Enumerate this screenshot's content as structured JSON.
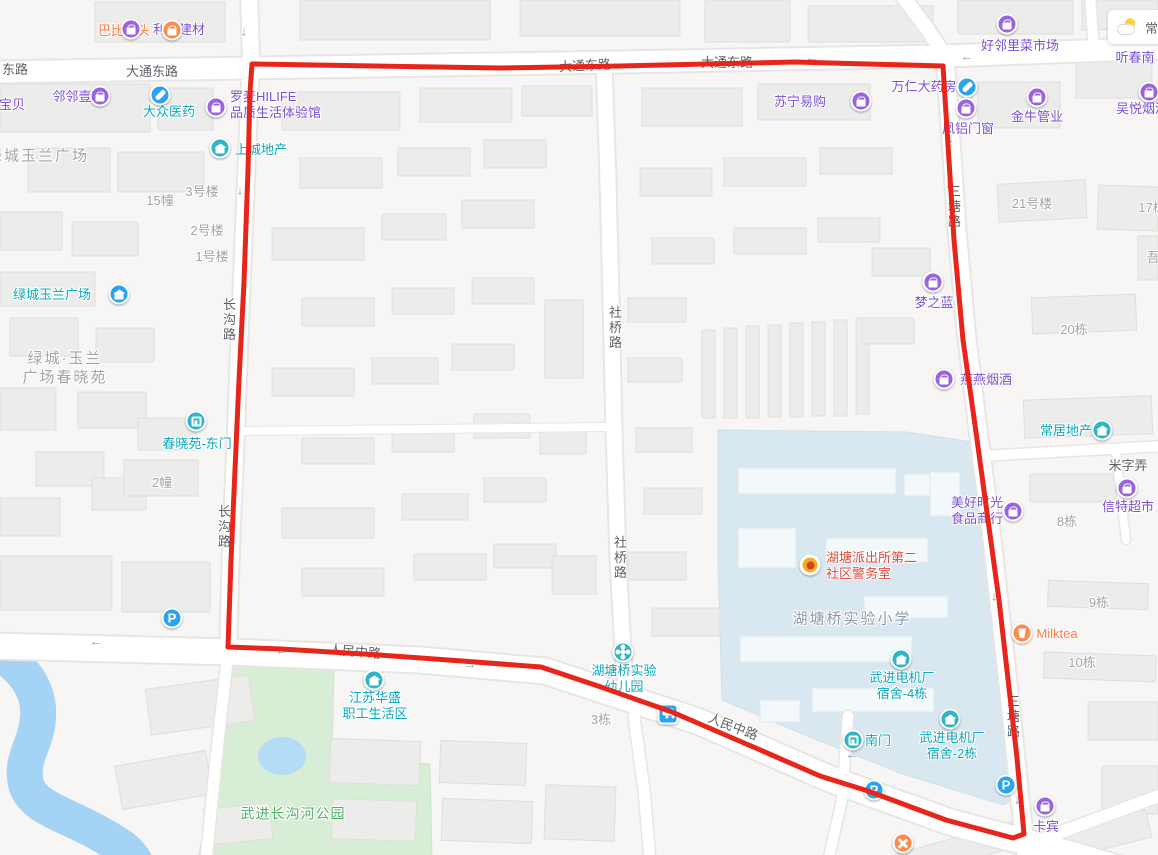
{
  "map": {
    "weather": {
      "city": "常州"
    },
    "colors": {
      "route_red": "#e8251a",
      "poi_purple": "#7b50d2",
      "poi_teal": "#0ba7b8",
      "poi_orange": "#ff7b40",
      "poi_red": "#de4a3c",
      "park_green_text": "#4fae67",
      "gray_label": "#a3a3a3",
      "road_label": "#5d6166",
      "school_text": "#8d99a6",
      "icon_purple": "#9a63df",
      "icon_teal": "#2fb5c5",
      "icon_blue": "#2aa3f3",
      "icon_orange": "#ff8a4e",
      "water": "#a5d3f5",
      "park": "#d8edd6",
      "campus": "#d9e7f0"
    },
    "road_labels": [
      {
        "t": "东路",
        "x": 15,
        "y": 70
      },
      {
        "t": "大通东路",
        "x": 152,
        "y": 72
      },
      {
        "t": "大通东路",
        "x": 585,
        "y": 66,
        "rot": -3
      },
      {
        "t": "大通东路",
        "x": 727,
        "y": 63
      },
      {
        "t": "长沟路",
        "x": 228,
        "y": 320,
        "v": 1
      },
      {
        "t": "长沟路",
        "x": 223,
        "y": 527,
        "v": 1
      },
      {
        "t": "社桥路",
        "x": 614,
        "y": 328,
        "v": 1
      },
      {
        "t": "社桥路",
        "x": 619,
        "y": 558,
        "v": 1
      },
      {
        "t": "三塘路",
        "x": 953,
        "y": 207,
        "v": 1
      },
      {
        "t": "三塘路",
        "x": 1012,
        "y": 717,
        "v": 1
      },
      {
        "t": "人民中路",
        "x": 355,
        "y": 652,
        "rot": 5
      },
      {
        "t": "人民中路",
        "x": 733,
        "y": 727,
        "rot": 21
      },
      {
        "t": "米字弄",
        "x": 1128,
        "y": 466
      }
    ],
    "area_labels": [
      {
        "t": "绿城玉兰广场",
        "x": 38,
        "y": 156
      },
      {
        "t": "绿城·玉兰\n广场春晓苑",
        "x": 65,
        "y": 368
      },
      {
        "t": "湖塘桥实验小学",
        "x": 852,
        "y": 619,
        "c": "grayblue"
      },
      {
        "t": "武进长沟河公园",
        "x": 293,
        "y": 814,
        "c": "green"
      }
    ],
    "building_labels": [
      {
        "t": "3号楼",
        "x": 202,
        "y": 192
      },
      {
        "t": "15幢",
        "x": 160,
        "y": 201
      },
      {
        "t": "2号楼",
        "x": 207,
        "y": 231
      },
      {
        "t": "1号楼",
        "x": 212,
        "y": 257
      },
      {
        "t": "2幢",
        "x": 162,
        "y": 483
      },
      {
        "t": "21号楼",
        "x": 1032,
        "y": 204
      },
      {
        "t": "17栋",
        "x": 1152,
        "y": 208
      },
      {
        "t": "吾",
        "x": 1153,
        "y": 258
      },
      {
        "t": "20栋",
        "x": 1074,
        "y": 330
      },
      {
        "t": "8栋",
        "x": 1067,
        "y": 522
      },
      {
        "t": "9栋",
        "x": 1099,
        "y": 603
      },
      {
        "t": "10栋",
        "x": 1082,
        "y": 663
      },
      {
        "t": "3栋",
        "x": 601,
        "y": 720
      }
    ],
    "pois": [
      {
        "t": "巴比馒头",
        "x": 124,
        "y": 31,
        "c": "orange",
        "icon": "bag",
        "ic": "orange",
        "ix": 172,
        "iy": 30
      },
      {
        "t": "利来建材",
        "x": 179,
        "y": 30,
        "c": "purple",
        "icon": "bag",
        "ic": "purple",
        "ix": 131,
        "iy": 29
      },
      {
        "t": "邻邻壹",
        "x": 72,
        "y": 97,
        "c": "purple",
        "icon": "bag",
        "ic": "purple",
        "ix": 100,
        "iy": 96
      },
      {
        "t": "宝贝",
        "x": 12,
        "y": 105,
        "c": "purple"
      },
      {
        "t": "大众医药",
        "x": 169,
        "y": 112,
        "c": "teal",
        "icon": "capsule",
        "ic": "blue",
        "ix": 160,
        "iy": 95
      },
      {
        "t": "罗麦HILIFE\n品质生活体验馆",
        "x": 230,
        "y": 105,
        "ax": "l",
        "c": "purple",
        "icon": "bag",
        "ic": "purple",
        "ix": 216,
        "iy": 107
      },
      {
        "t": "上城地产",
        "x": 261,
        "y": 150,
        "c": "teal",
        "icon": "house",
        "ic": "teal",
        "ix": 220,
        "iy": 148
      },
      {
        "t": "绿城玉兰广场",
        "x": 52,
        "y": 295,
        "c": "teal",
        "icon": "house",
        "ic": "blue",
        "ix": 119,
        "iy": 294
      },
      {
        "t": "春晓苑-东门",
        "x": 197,
        "y": 444,
        "c": "teal",
        "icon": "gate",
        "ic": "teal",
        "ix": 196,
        "iy": 421
      },
      {
        "t": "万仁大药房",
        "x": 924,
        "y": 87,
        "c": "purple",
        "icon": "capsule",
        "ic": "blue",
        "ix": 967,
        "iy": 87
      },
      {
        "t": "苏宁易购",
        "x": 800,
        "y": 102,
        "c": "purple",
        "icon": "bag",
        "ic": "purple",
        "ix": 861,
        "iy": 101
      },
      {
        "t": "好邻里菜市场",
        "x": 1020,
        "y": 46,
        "c": "purple",
        "icon": "bag",
        "ic": "purple",
        "ix": 1007,
        "iy": 24
      },
      {
        "t": "凤铝门窗",
        "x": 968,
        "y": 129,
        "c": "purple",
        "icon": "bag",
        "ic": "purple",
        "ix": 966,
        "iy": 108
      },
      {
        "t": "金牛管业",
        "x": 1037,
        "y": 117,
        "c": "purple",
        "icon": "bag",
        "ic": "purple",
        "ix": 1037,
        "iy": 97
      },
      {
        "t": "吴悦烟酒",
        "x": 1142,
        "y": 109,
        "c": "purple",
        "icon": "bag",
        "ic": "purple",
        "ix": 1149,
        "iy": 92
      },
      {
        "t": "梦之蓝",
        "x": 934,
        "y": 303,
        "c": "purple",
        "icon": "bag",
        "ic": "purple",
        "ix": 933,
        "iy": 282
      },
      {
        "t": "燕燕烟酒",
        "x": 986,
        "y": 380,
        "c": "purple",
        "icon": "bag",
        "ic": "purple",
        "ix": 944,
        "iy": 379
      },
      {
        "t": "常居地产",
        "x": 1066,
        "y": 431,
        "c": "teal",
        "icon": "house",
        "ic": "teal",
        "ix": 1102,
        "iy": 430
      },
      {
        "t": "美好时光\n食品商行",
        "x": 977,
        "y": 511,
        "c": "purple",
        "icon": "bag",
        "ic": "purple",
        "ix": 1013,
        "iy": 511
      },
      {
        "t": "信特超市",
        "x": 1128,
        "y": 507,
        "c": "purple",
        "icon": "bag",
        "ic": "purple",
        "ix": 1127,
        "iy": 488
      },
      {
        "t": "Milktea",
        "x": 1057,
        "y": 634,
        "c": "orange",
        "icon": "cup",
        "ic": "orange",
        "ix": 1022,
        "iy": 633
      },
      {
        "t": "卡宾",
        "x": 1046,
        "y": 827,
        "c": "purple",
        "icon": "bag",
        "ic": "purple",
        "ix": 1045,
        "iy": 806
      },
      {
        "t": "湖塘派出所第二\n社区警务室",
        "x": 826,
        "y": 566,
        "ax": "l",
        "c": "red",
        "icon": "badge",
        "ic": "badge",
        "ix": 810,
        "iy": 565
      },
      {
        "t": "湖塘桥实验\n幼儿园",
        "x": 624,
        "y": 679,
        "c": "teal",
        "icon": "pin",
        "ic": "teal",
        "ix": 623,
        "iy": 652
      },
      {
        "t": "江苏华盛\n职工生活区",
        "x": 375,
        "y": 706,
        "c": "teal",
        "icon": "house",
        "ic": "teal",
        "ix": 374,
        "iy": 680
      },
      {
        "t": "武进电机厂\n宿舍-4栋",
        "x": 902,
        "y": 686,
        "c": "teal",
        "icon": "house",
        "ic": "teal",
        "ix": 901,
        "iy": 659
      },
      {
        "t": "南门",
        "x": 878,
        "y": 741,
        "c": "teal",
        "icon": "gate",
        "ic": "teal",
        "ix": 853,
        "iy": 740
      },
      {
        "t": "武进电机厂\n宿舍-2栋",
        "x": 952,
        "y": 746,
        "c": "teal",
        "icon": "house",
        "ic": "teal",
        "ix": 950,
        "iy": 719
      },
      {
        "t": "听春南",
        "x": 1135,
        "y": 58,
        "c": "purple"
      }
    ],
    "markers": [
      {
        "n": "parking",
        "g": "p",
        "ic": "blue",
        "x": 172,
        "y": 618
      },
      {
        "n": "parking",
        "g": "p",
        "ic": "blue",
        "x": 874,
        "y": 790
      },
      {
        "n": "parking",
        "g": "p",
        "ic": "blue",
        "x": 1006,
        "y": 785
      },
      {
        "n": "bus-stop",
        "g": "bus",
        "ic": "blue",
        "x": 668,
        "y": 714
      },
      {
        "n": "restaurant",
        "g": "food",
        "ic": "orange",
        "x": 903,
        "y": 843
      }
    ],
    "arrows": [
      {
        "d": "down",
        "x": 244,
        "y": 31
      },
      {
        "d": "left",
        "x": 812,
        "y": 57
      },
      {
        "d": "left",
        "x": 967,
        "y": 56
      },
      {
        "d": "down",
        "x": 951,
        "y": 138
      },
      {
        "d": "down",
        "x": 948,
        "y": 183
      },
      {
        "d": "down",
        "x": 240,
        "y": 190
      },
      {
        "d": "left",
        "x": 282,
        "y": 650
      },
      {
        "d": "right",
        "x": 470,
        "y": 664
      },
      {
        "d": "left",
        "x": 96,
        "y": 641
      },
      {
        "d": "down",
        "x": 994,
        "y": 596
      },
      {
        "d": "left",
        "x": 852,
        "y": 754
      },
      {
        "d": "down",
        "x": 1017,
        "y": 799
      }
    ]
  }
}
